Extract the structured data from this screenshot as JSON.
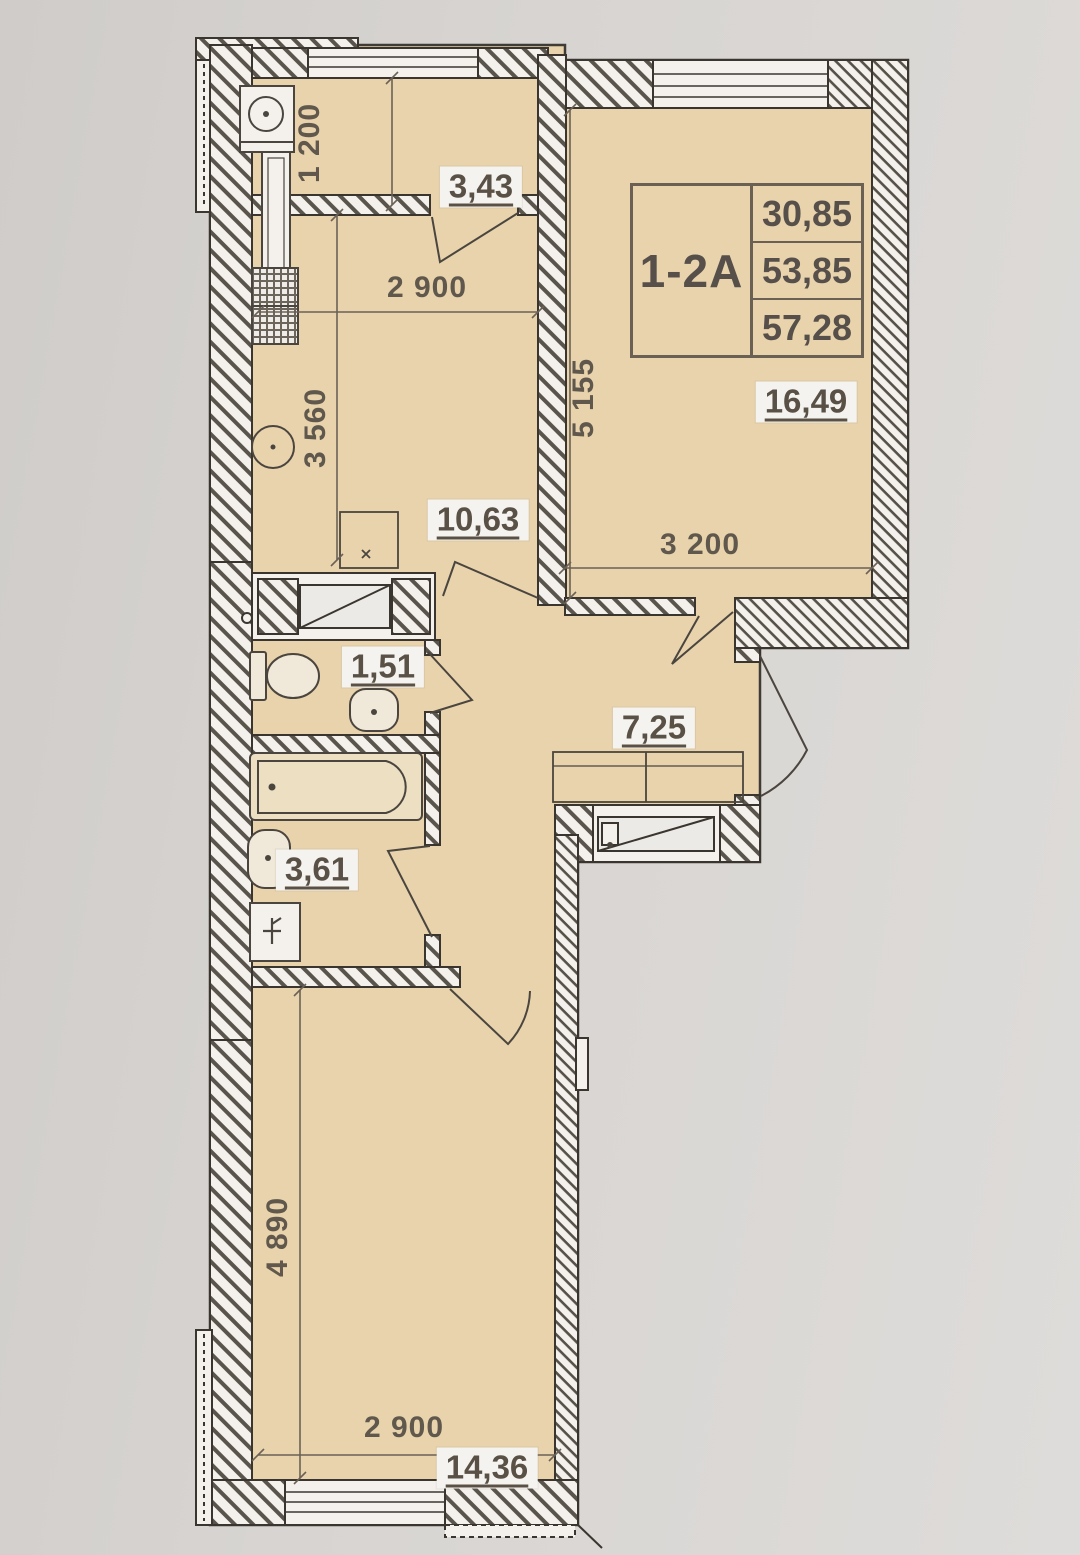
{
  "unit": {
    "label": "1-2A",
    "area_rows": [
      "30,85",
      "53,85",
      "57,28"
    ]
  },
  "room_areas": {
    "balcony": "3,43",
    "kitchen": "10,63",
    "living_room": "16,49",
    "wc": "1,51",
    "hall": "7,25",
    "bathroom": "3,61",
    "bedroom": "14,36"
  },
  "dimensions": {
    "balcony_width": "1 200",
    "kitchen_width": "2 900",
    "kitchen_depth": "3 560",
    "living_depth": "5 155",
    "living_width": "3 200",
    "bedroom_depth": "4 890",
    "bedroom_width": "2 900"
  }
}
